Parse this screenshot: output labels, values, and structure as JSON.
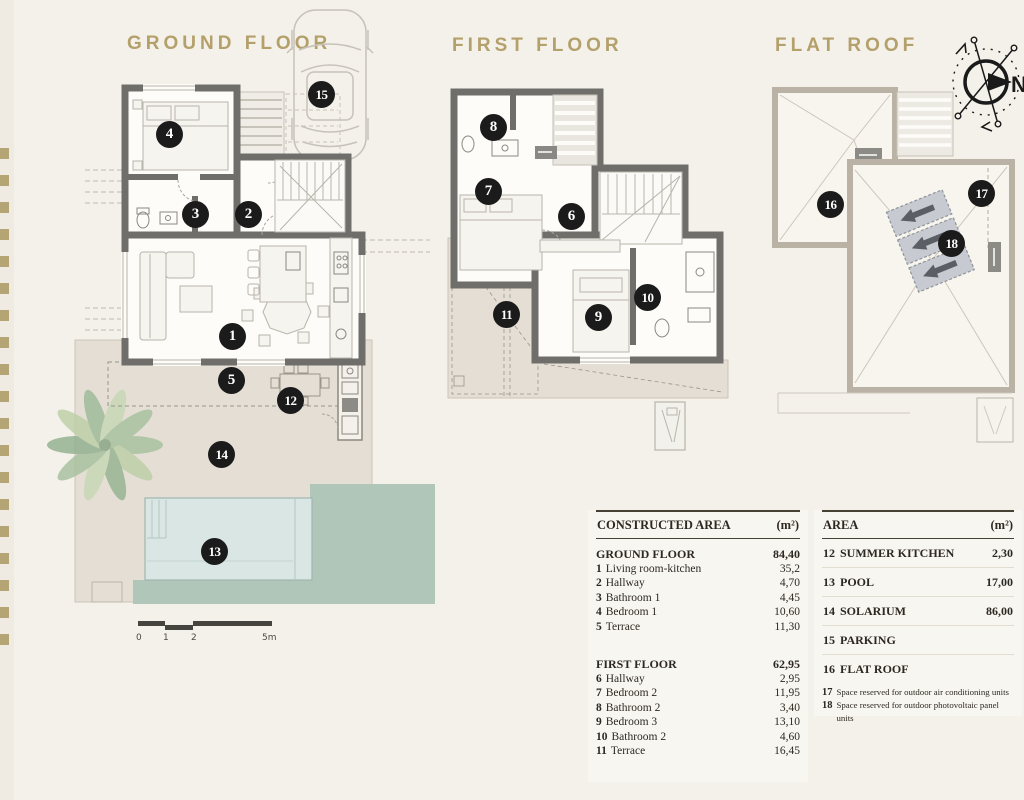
{
  "colors": {
    "background": "#f4f1ea",
    "accent_gold": "#b3a06b",
    "marker_black": "#1b1b1b",
    "wall_gray": "#6f6e6b",
    "terrace_beige": "#e4ded4",
    "pool_blue": "#d9e6e3",
    "grass_green": "#afc6b8"
  },
  "sections": {
    "ground": {
      "title": "GROUND FLOOR"
    },
    "first": {
      "title": "FIRST FLOOR"
    },
    "roof": {
      "title": "FLAT ROOF"
    }
  },
  "compass": {
    "north": "N"
  },
  "scale": {
    "labels": [
      "0",
      "1",
      "2",
      "5m"
    ]
  },
  "markers": {
    "m1": "1",
    "m2": "2",
    "m3": "3",
    "m4": "4",
    "m5": "5",
    "m6": "6",
    "m7": "7",
    "m8": "8",
    "m9": "9",
    "m10": "10",
    "m11": "11",
    "m12": "12",
    "m13": "13",
    "m14": "14",
    "m15": "15",
    "m16": "16",
    "m17": "17",
    "m18": "18"
  },
  "tables": {
    "constructed": {
      "header": "CONSTRUCTED AREA",
      "unit": "(m²)",
      "groups": [
        {
          "title": "GROUND FLOOR",
          "total": "84,40",
          "rows": [
            {
              "num": "1",
              "label": "Living room-kitchen",
              "value": "35,2"
            },
            {
              "num": "2",
              "label": "Hallway",
              "value": "4,70"
            },
            {
              "num": "3",
              "label": "Bathroom 1",
              "value": "4,45"
            },
            {
              "num": "4",
              "label": "Bedroom 1",
              "value": "10,60"
            },
            {
              "num": "5",
              "label": "Terrace",
              "value": "11,30"
            }
          ]
        },
        {
          "title": "FIRST FLOOR",
          "total": "62,95",
          "rows": [
            {
              "num": "6",
              "label": "Hallway",
              "value": "2,95"
            },
            {
              "num": "7",
              "label": "Bedroom 2",
              "value": "11,95"
            },
            {
              "num": "8",
              "label": "Bathroom 2",
              "value": "3,40"
            },
            {
              "num": "9",
              "label": "Bedroom 3",
              "value": "13,10"
            },
            {
              "num": "10",
              "label": "Bathroom 2",
              "value": "4,60"
            },
            {
              "num": "11",
              "label": "Terrace",
              "value": "16,45"
            }
          ]
        }
      ]
    },
    "area": {
      "header": "AREA",
      "unit": "(m²)",
      "rows": [
        {
          "num": "12",
          "label": "SUMMER KITCHEN",
          "value": "2,30"
        },
        {
          "num": "13",
          "label": "POOL",
          "value": "17,00"
        },
        {
          "num": "14",
          "label": "SOLARIUM",
          "value": "86,00"
        },
        {
          "num": "15",
          "label": "PARKING",
          "value": ""
        },
        {
          "num": "16",
          "label": "FLAT ROOF",
          "value": ""
        }
      ],
      "notes": [
        {
          "num": "17",
          "label": "Space reserved for outdoor air conditioning units"
        },
        {
          "num": "18",
          "label": "Space reserved for outdoor photovoltaic panel units"
        }
      ]
    }
  }
}
